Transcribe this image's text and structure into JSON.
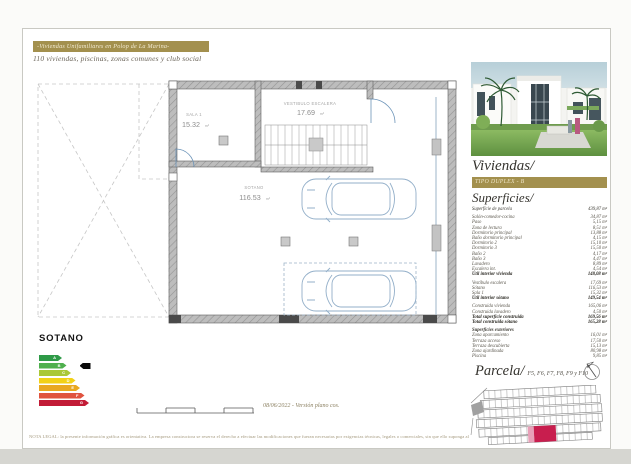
{
  "header": {
    "banner": "-Viviendas Unifamiliares en Polop de La Marina-",
    "subtitle": "110 viviendas, piscinas, zonas comunes y club social"
  },
  "plan": {
    "rooms": [
      {
        "name": "SALA 1",
        "area": "15.32",
        "unit": "m²"
      },
      {
        "name": "VESTIBULO ESCALERA",
        "area": "17.69",
        "unit": "m²"
      },
      {
        "name": "SOTANO",
        "area": "116.53",
        "unit": "m²"
      }
    ],
    "floor_label": "SOTANO"
  },
  "energy": {
    "ratings": [
      {
        "letter": "A",
        "color": "#2e9a47"
      },
      {
        "letter": "B",
        "color": "#4fb04e"
      },
      {
        "letter": "C",
        "color": "#aac836"
      },
      {
        "letter": "D",
        "color": "#f2d117"
      },
      {
        "letter": "E",
        "color": "#e9a820"
      },
      {
        "letter": "F",
        "color": "#e0533f"
      },
      {
        "letter": "G",
        "color": "#c21b36"
      }
    ],
    "marker_letter": "B"
  },
  "footer": {
    "scale_note": "08/06/2022 - Versión plano cos.",
    "legal": "NOTA LEGAL: la presente información gráfica es orientativa. La empresa constructora se reserva el derecho a efectuar las modificaciones que fueran necesarias por exigencias técnicas, legales o comerciales, sin que ello suponga alteración de la calidad de las viviendas."
  },
  "sidebar": {
    "title": "Viviendas/",
    "type_banner": "TIPO DUPLEX - B",
    "superficies_title": "Superficies/",
    "table_rows": [
      {
        "label": "Superficie de parcela",
        "value": "439,87 m²",
        "style": "head"
      },
      {
        "style": "spacer"
      },
      {
        "label": "Salón-comedor-cocina",
        "value": "34,87 m²",
        "style": ""
      },
      {
        "label": "Paso",
        "value": "5,15 m²",
        "style": ""
      },
      {
        "label": "Zona de lectura",
        "value": "8,51 m²",
        "style": ""
      },
      {
        "label": "Dormitorio principal",
        "value": "13,88 m²",
        "style": ""
      },
      {
        "label": "Baño dormitorio principal",
        "value": "4,15 m²",
        "style": ""
      },
      {
        "label": "Dormitorio 2",
        "value": "15,10 m²",
        "style": ""
      },
      {
        "label": "Dormitorio 3",
        "value": "15,50 m²",
        "style": ""
      },
      {
        "label": "Baño 2",
        "value": "4,17 m²",
        "style": ""
      },
      {
        "label": "Baño 3",
        "value": "4,47 m²",
        "style": ""
      },
      {
        "label": "Lavadero",
        "value": "8,89 m²",
        "style": ""
      },
      {
        "label": "Escalera int.",
        "value": "4,54 m²",
        "style": ""
      },
      {
        "label": "Útil interior vivienda",
        "value": "148,08 m²",
        "style": "bold"
      },
      {
        "style": "spacer"
      },
      {
        "label": "Vestíbulo escalera",
        "value": "17,69 m²",
        "style": ""
      },
      {
        "label": "Sótano",
        "value": "116,53 m²",
        "style": ""
      },
      {
        "label": "Sala 1",
        "value": "15,32 m²",
        "style": ""
      },
      {
        "label": "Útil interior sótano",
        "value": "149,54 m²",
        "style": "bold"
      },
      {
        "style": "spacer"
      },
      {
        "label": "Construida vivienda",
        "value": "165,06 m²",
        "style": ""
      },
      {
        "label": "Construida lavadero",
        "value": "4,50 m²",
        "style": ""
      },
      {
        "label": "Total superficie construida",
        "value": "169,56 m²",
        "style": "bold"
      },
      {
        "label": "Total construida sótano",
        "value": "165,28 m²",
        "style": "bold"
      },
      {
        "style": "spacer"
      },
      {
        "label": "Superficies exteriores",
        "value": "",
        "style": "sub"
      },
      {
        "label": "Zona aparcamiento",
        "value": "16,01 m²",
        "style": ""
      },
      {
        "label": "Terraza acceso",
        "value": "17,50 m²",
        "style": ""
      },
      {
        "label": "Terraza descubierta",
        "value": "15,13 m²",
        "style": ""
      },
      {
        "label": "Zona ajardinada",
        "value": "80,98 m²",
        "style": ""
      },
      {
        "label": "Piscina",
        "value": "9,85 m²",
        "style": ""
      }
    ],
    "parcela_title": "Parcela/",
    "parcela_plots": "F5, F6, F7, F8, F9 y F10"
  },
  "colors": {
    "accent_gold": "#a3904e",
    "plot_highlight": "#c81e4e",
    "car_outline": "#93afc9"
  }
}
